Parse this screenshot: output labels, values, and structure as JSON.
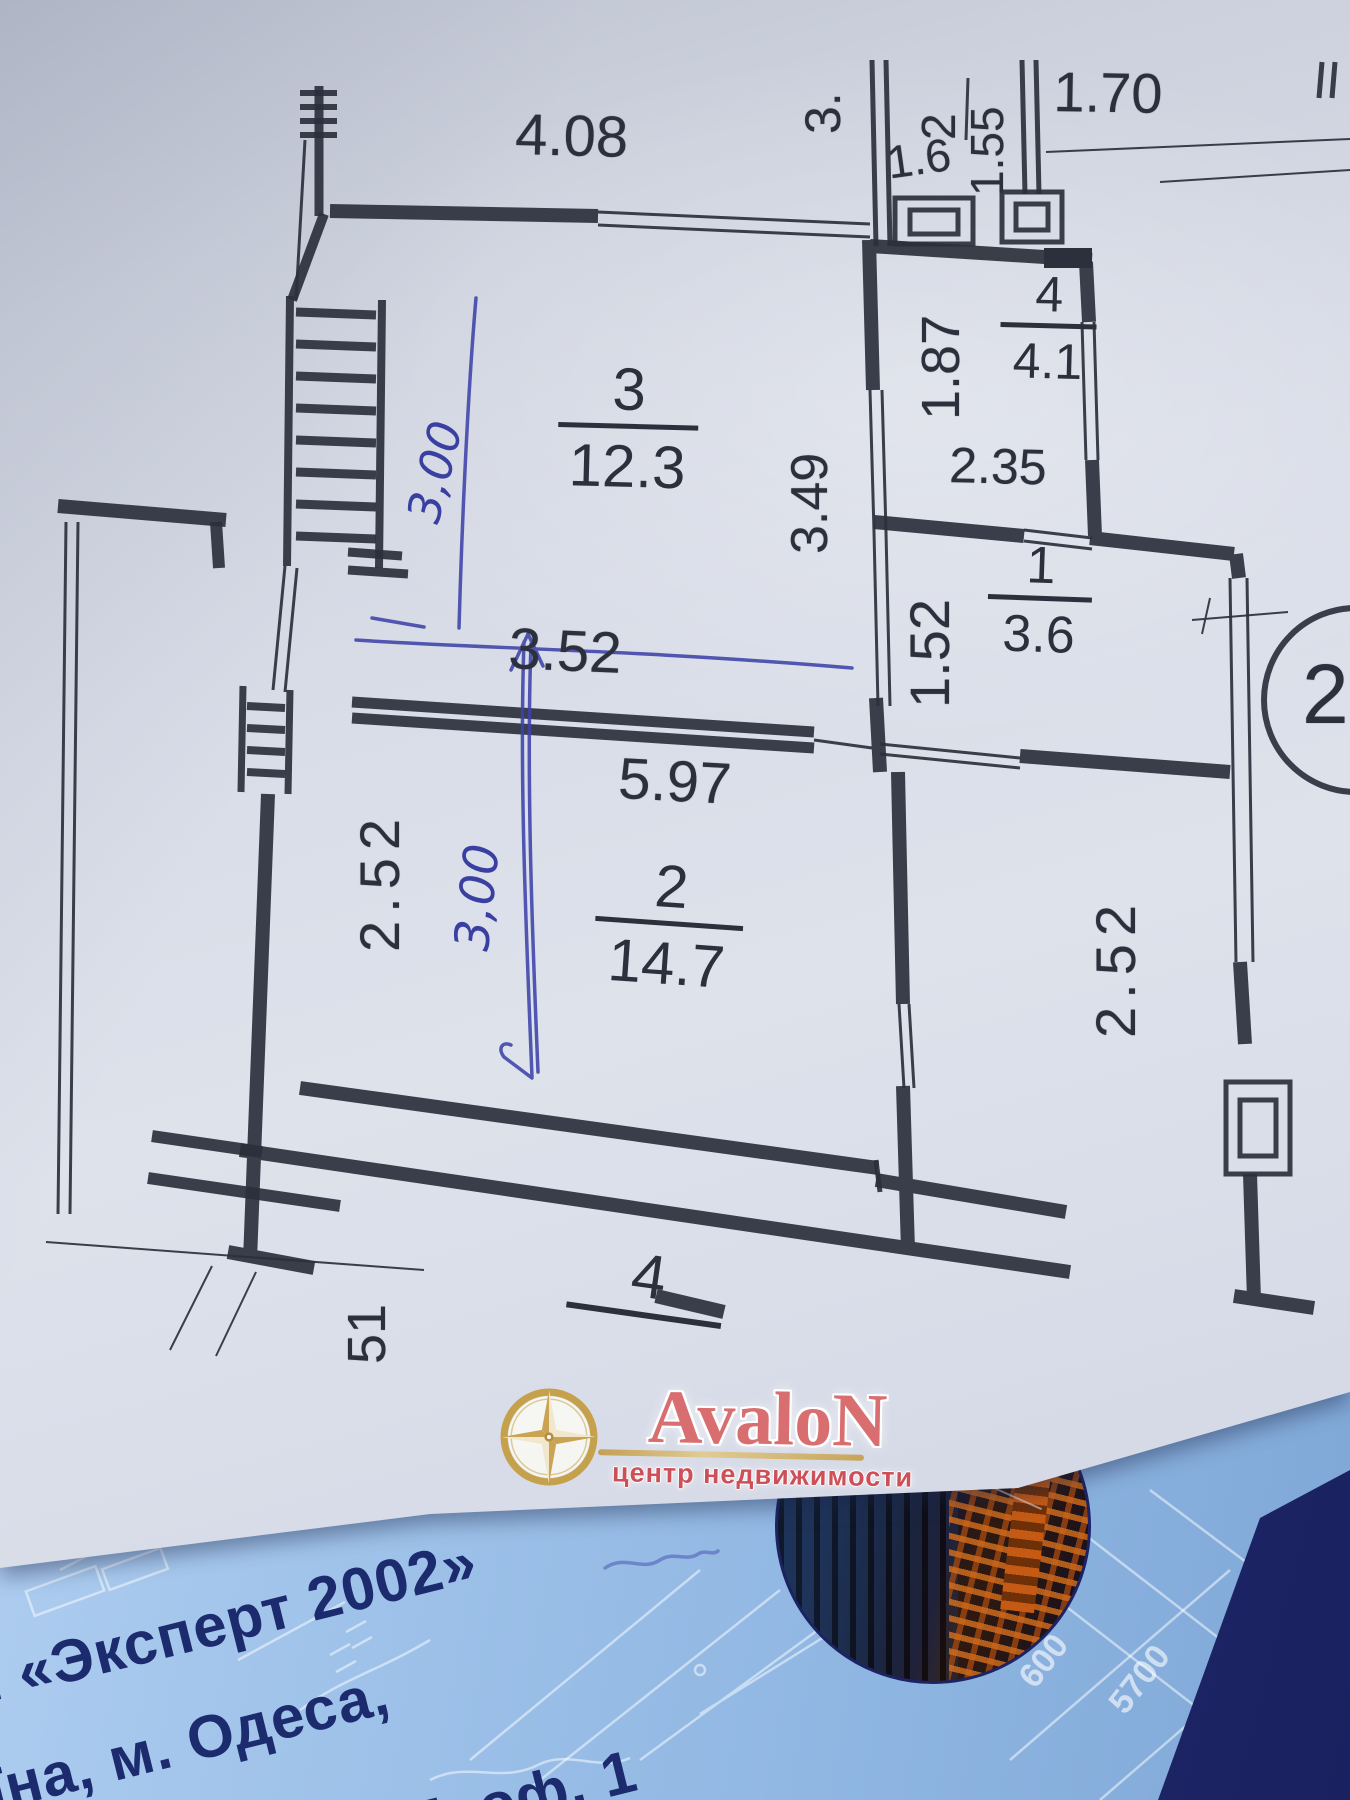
{
  "plan": {
    "dims": {
      "top_width": "4.08",
      "vest_left": "3.",
      "vest_width": "1.6",
      "vest_depth": "1.55",
      "entry_width": "1.70",
      "room4_depth": "1.87",
      "room4_width": "2.35",
      "room3_depth": "3.49",
      "opening_width": "3.52",
      "room1_depth": "1.52",
      "corridor_width": "5.97",
      "left_depth": "2.52",
      "right_depth": "2.52",
      "bottom_partial": "51"
    },
    "rooms": {
      "vestibule": {
        "number": "2"
      },
      "room3": {
        "number": "3",
        "area": "12.3"
      },
      "room4": {
        "number": "4",
        "area": "4.1"
      },
      "room1": {
        "number": "1",
        "area": "3.6"
      },
      "room2": {
        "number": "2",
        "area": "14.7"
      },
      "room4_lower": {
        "number": "4"
      }
    },
    "callout_number": "2",
    "handwritten": {
      "width_note": "3,00",
      "height_note": "3,00"
    }
  },
  "logo": {
    "brand": "AvaloN",
    "tagline": "центр недвижимости"
  },
  "card": {
    "line1": "П «Эксперт 2002»",
    "line2": "їна, м. Одеса,",
    "line3": "27, оф. 1",
    "wm_dim1": "5700",
    "wm_dim2": "600"
  }
}
